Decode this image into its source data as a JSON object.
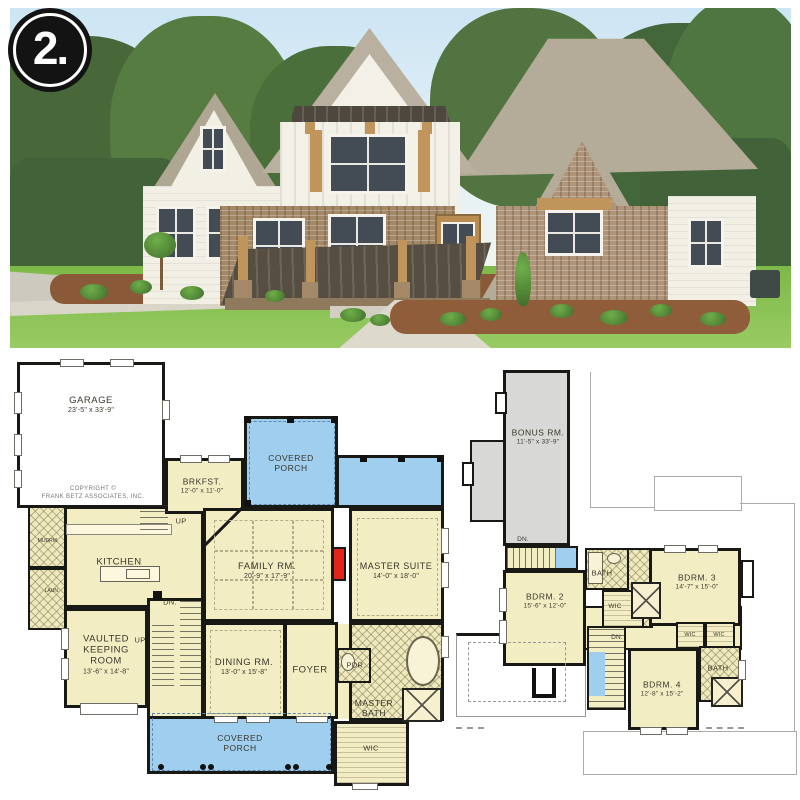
{
  "badge": {
    "number": "2."
  },
  "colors": {
    "plan_room_fill": "#F3EDC4",
    "porch_fill": "#9FCEEE",
    "bonus_fill": "#D8D8D6",
    "wall": "#181814",
    "fireplace_red": "#E0251C",
    "badge_bg": "#131313",
    "badge_text": "#FFFFFF"
  },
  "plan1": {
    "copyright": {
      "line1": "COPYRIGHT ©",
      "line2": "FRANK BETZ ASSOCIATES, INC."
    },
    "rooms": {
      "garage": {
        "name": "GARAGE",
        "dims": "23'-5\" x 33'-9\""
      },
      "brkfst": {
        "name": "BRKFST.",
        "dims": "12'-0\" x 11'-0\""
      },
      "porch_top": {
        "name": "COVERED PORCH"
      },
      "family": {
        "name": "FAMILY RM.",
        "dims": "20'-9\" x 17'-9\""
      },
      "master_suite": {
        "name": "MASTER SUITE",
        "dims": "14'-0\" x 18'-0\""
      },
      "kitchen": {
        "name": "KITCHEN"
      },
      "keeping": {
        "name": "VAULTED KEEPING ROOM",
        "dims": "13'-6\" x 14'-8\""
      },
      "dining": {
        "name": "DINING RM.",
        "dims": "13'-0\" x 15'-8\""
      },
      "foyer": {
        "name": "FOYER"
      },
      "pdr": {
        "name": "PDR."
      },
      "master_bath": {
        "name": "MASTER BATH"
      },
      "wic": {
        "name": "WIC"
      },
      "porch_bottom": {
        "name": "COVERED PORCH"
      },
      "mudrm": {
        "name": "MUDRM."
      },
      "laun": {
        "name": "LAUN."
      }
    },
    "stairs": {
      "up_back": "UP",
      "dn_main": "DN.",
      "up_main": "UP"
    }
  },
  "plan2": {
    "rooms": {
      "bonus": {
        "name": "BONUS RM.",
        "dims": "11'-5\" x 33'-9\""
      },
      "bdrm2": {
        "name": "BDRM. 2",
        "dims": "15'-6\" x 12'-0\""
      },
      "bath_top": {
        "name": "BATH"
      },
      "wic_a": {
        "name": "WIC"
      },
      "bdrm3": {
        "name": "BDRM. 3",
        "dims": "14'-7\" x 15'-0\""
      },
      "wic_b": {
        "name": "WIC"
      },
      "wic_c": {
        "name": "WIC"
      },
      "bdrm4": {
        "name": "BDRM. 4",
        "dims": "12'-8\" x 15'-2\""
      },
      "bath_bottom": {
        "name": "BATH"
      }
    },
    "stairs": {
      "dn_bonus": "DN.",
      "dn_main": "DN."
    }
  }
}
